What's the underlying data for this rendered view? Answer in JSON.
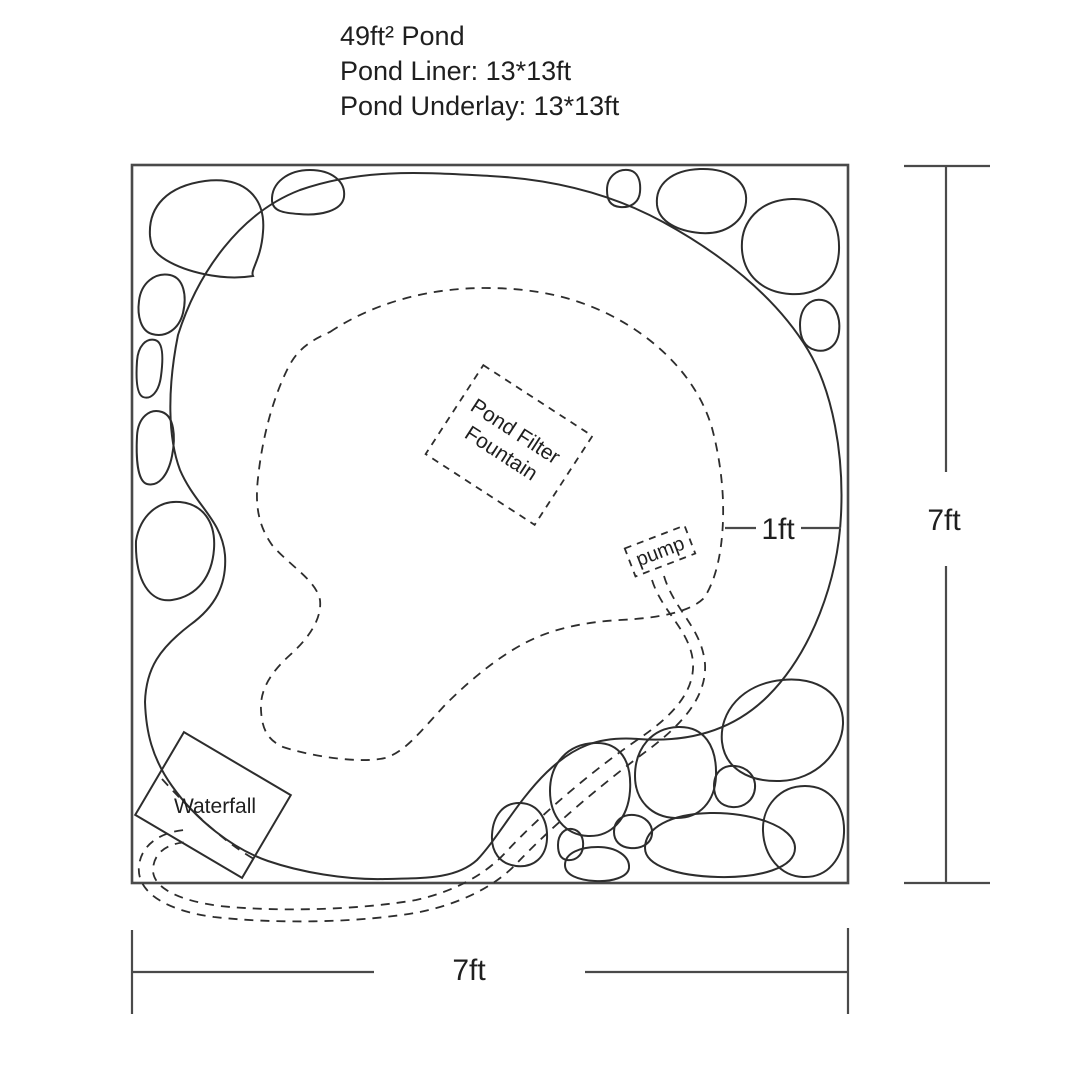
{
  "header": {
    "title": "49ft² Pond",
    "liner": "Pond Liner: 13*13ft",
    "underlay": "Pond Underlay: 13*13ft"
  },
  "labels": {
    "pond_filter_line1": "Pond Filter",
    "pond_filter_line2": "Fountain",
    "pump": "pump",
    "waterfall": "Waterfall",
    "shelf_width": "1ft",
    "side_height": "7ft",
    "bottom_width": "7ft"
  },
  "colors": {
    "ink": "#2d2d2d",
    "frame": "#4a4a4a",
    "text": "#1f1f1f",
    "background": "#ffffff"
  }
}
